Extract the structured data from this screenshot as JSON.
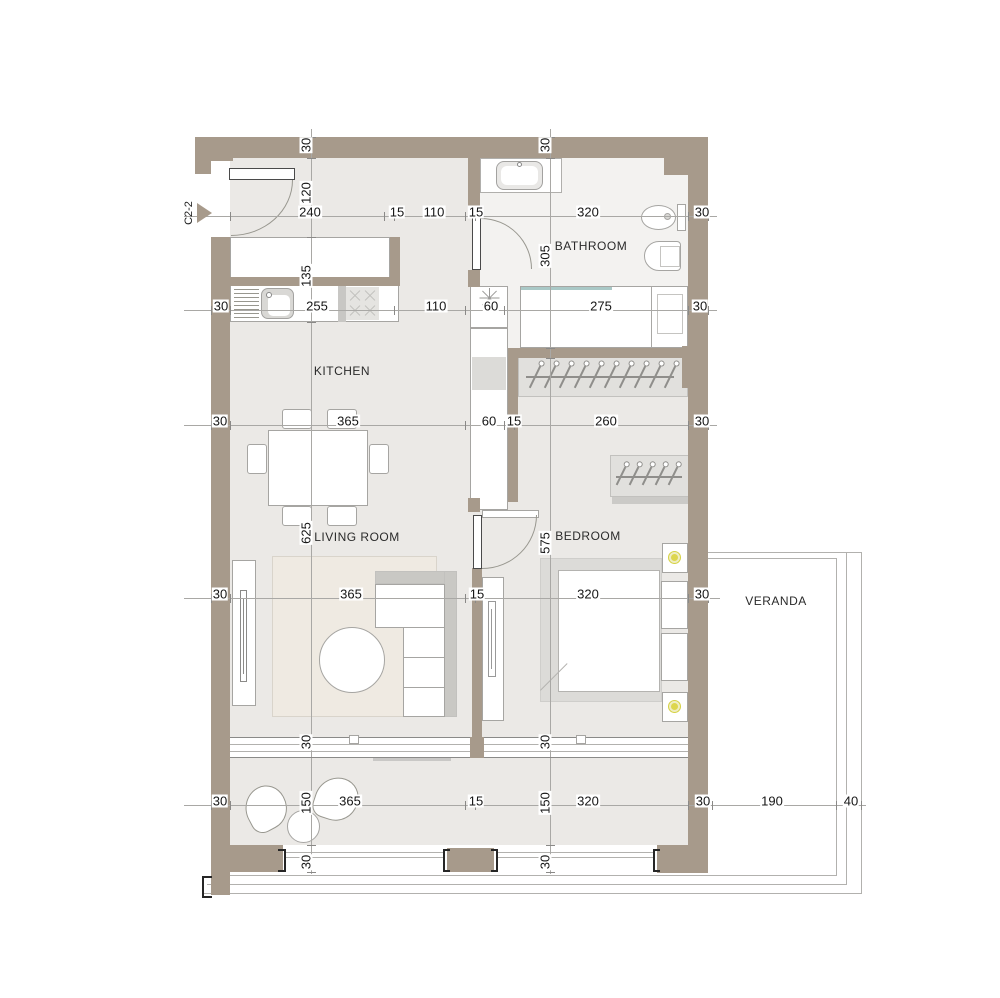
{
  "unit_marker": {
    "label": "C2-2"
  },
  "rooms": [
    {
      "id": "kitchen",
      "label": "KITCHEN",
      "x": 342,
      "y": 371
    },
    {
      "id": "bathroom",
      "label": "BATHROOM",
      "x": 591,
      "y": 246
    },
    {
      "id": "living-room",
      "label": "LIVING ROOM",
      "x": 357,
      "y": 537
    },
    {
      "id": "bedroom",
      "label": "BEDROOM",
      "x": 588,
      "y": 536
    },
    {
      "id": "veranda",
      "label": "VERANDA",
      "x": 776,
      "y": 601
    }
  ],
  "dim_lines": [
    {
      "o": "h",
      "y": 216,
      "x1": 184,
      "x2": 717,
      "ticks": [
        230,
        384,
        394,
        465,
        475,
        688,
        708
      ]
    },
    {
      "o": "h",
      "y": 310,
      "x1": 184,
      "x2": 717,
      "ticks": [
        211,
        230,
        394,
        465,
        504,
        688,
        708
      ]
    },
    {
      "o": "h",
      "y": 425,
      "x1": 184,
      "x2": 717,
      "ticks": [
        211,
        230,
        465,
        504,
        514,
        688,
        708
      ]
    },
    {
      "o": "h",
      "y": 598,
      "x1": 184,
      "x2": 720,
      "ticks": [
        211,
        230,
        465,
        475,
        688,
        708
      ]
    },
    {
      "o": "h",
      "y": 805,
      "x1": 184,
      "x2": 866,
      "ticks": [
        211,
        230,
        465,
        475,
        688,
        712,
        836,
        861
      ]
    },
    {
      "o": "v",
      "x": 311,
      "y1": 129,
      "y2": 874,
      "ticks": [
        137,
        158,
        237,
        322,
        737,
        757,
        845,
        872
      ]
    },
    {
      "o": "v",
      "x": 550,
      "y1": 129,
      "y2": 874,
      "ticks": [
        137,
        158,
        348,
        358,
        737,
        757,
        845,
        872
      ]
    }
  ],
  "dim_h": [
    {
      "t": "240",
      "x": 310,
      "y": 212
    },
    {
      "t": "15",
      "x": 397,
      "y": 212
    },
    {
      "t": "110",
      "x": 434,
      "y": 212
    },
    {
      "t": "15",
      "x": 476,
      "y": 212
    },
    {
      "t": "320",
      "x": 588,
      "y": 212
    },
    {
      "t": "30",
      "x": 702,
      "y": 212
    },
    {
      "t": "30",
      "x": 221,
      "y": 306
    },
    {
      "t": "255",
      "x": 317,
      "y": 306
    },
    {
      "t": "110",
      "x": 436,
      "y": 306
    },
    {
      "t": "60",
      "x": 491,
      "y": 306
    },
    {
      "t": "275",
      "x": 601,
      "y": 306
    },
    {
      "t": "30",
      "x": 700,
      "y": 306
    },
    {
      "t": "30",
      "x": 220,
      "y": 421
    },
    {
      "t": "365",
      "x": 348,
      "y": 421
    },
    {
      "t": "60",
      "x": 489,
      "y": 421
    },
    {
      "t": "15",
      "x": 514,
      "y": 421
    },
    {
      "t": "260",
      "x": 606,
      "y": 421
    },
    {
      "t": "30",
      "x": 702,
      "y": 421
    },
    {
      "t": "30",
      "x": 220,
      "y": 594
    },
    {
      "t": "365",
      "x": 351,
      "y": 594
    },
    {
      "t": "15",
      "x": 477,
      "y": 594
    },
    {
      "t": "320",
      "x": 588,
      "y": 594
    },
    {
      "t": "30",
      "x": 702,
      "y": 594
    },
    {
      "t": "30",
      "x": 220,
      "y": 801
    },
    {
      "t": "365",
      "x": 350,
      "y": 801
    },
    {
      "t": "15",
      "x": 476,
      "y": 801
    },
    {
      "t": "320",
      "x": 588,
      "y": 801
    },
    {
      "t": "30",
      "x": 703,
      "y": 801
    },
    {
      "t": "190",
      "x": 772,
      "y": 801
    },
    {
      "t": "40",
      "x": 851,
      "y": 801
    }
  ],
  "dim_v": [
    {
      "t": "30",
      "x": 306,
      "y": 145
    },
    {
      "t": "120",
      "x": 306,
      "y": 193
    },
    {
      "t": "135",
      "x": 306,
      "y": 276
    },
    {
      "t": "625",
      "x": 306,
      "y": 533
    },
    {
      "t": "30",
      "x": 306,
      "y": 742
    },
    {
      "t": "150",
      "x": 306,
      "y": 803
    },
    {
      "t": "30",
      "x": 306,
      "y": 862
    },
    {
      "t": "30",
      "x": 545,
      "y": 145
    },
    {
      "t": "305",
      "x": 545,
      "y": 256
    },
    {
      "t": "575",
      "x": 545,
      "y": 543
    },
    {
      "t": "30",
      "x": 545,
      "y": 742
    },
    {
      "t": "150",
      "x": 545,
      "y": 803
    },
    {
      "t": "30",
      "x": 545,
      "y": 862
    }
  ],
  "colors": {
    "wall": "#a79a8b",
    "floor": "#ebe9e6",
    "bathroom_floor": "#f3f2f0",
    "rug": "#efeae2",
    "glass_screen": "#a9c8c6",
    "lamp": "#ddd64e",
    "dim_line": "#a9a8a5",
    "ink": "#161616"
  }
}
